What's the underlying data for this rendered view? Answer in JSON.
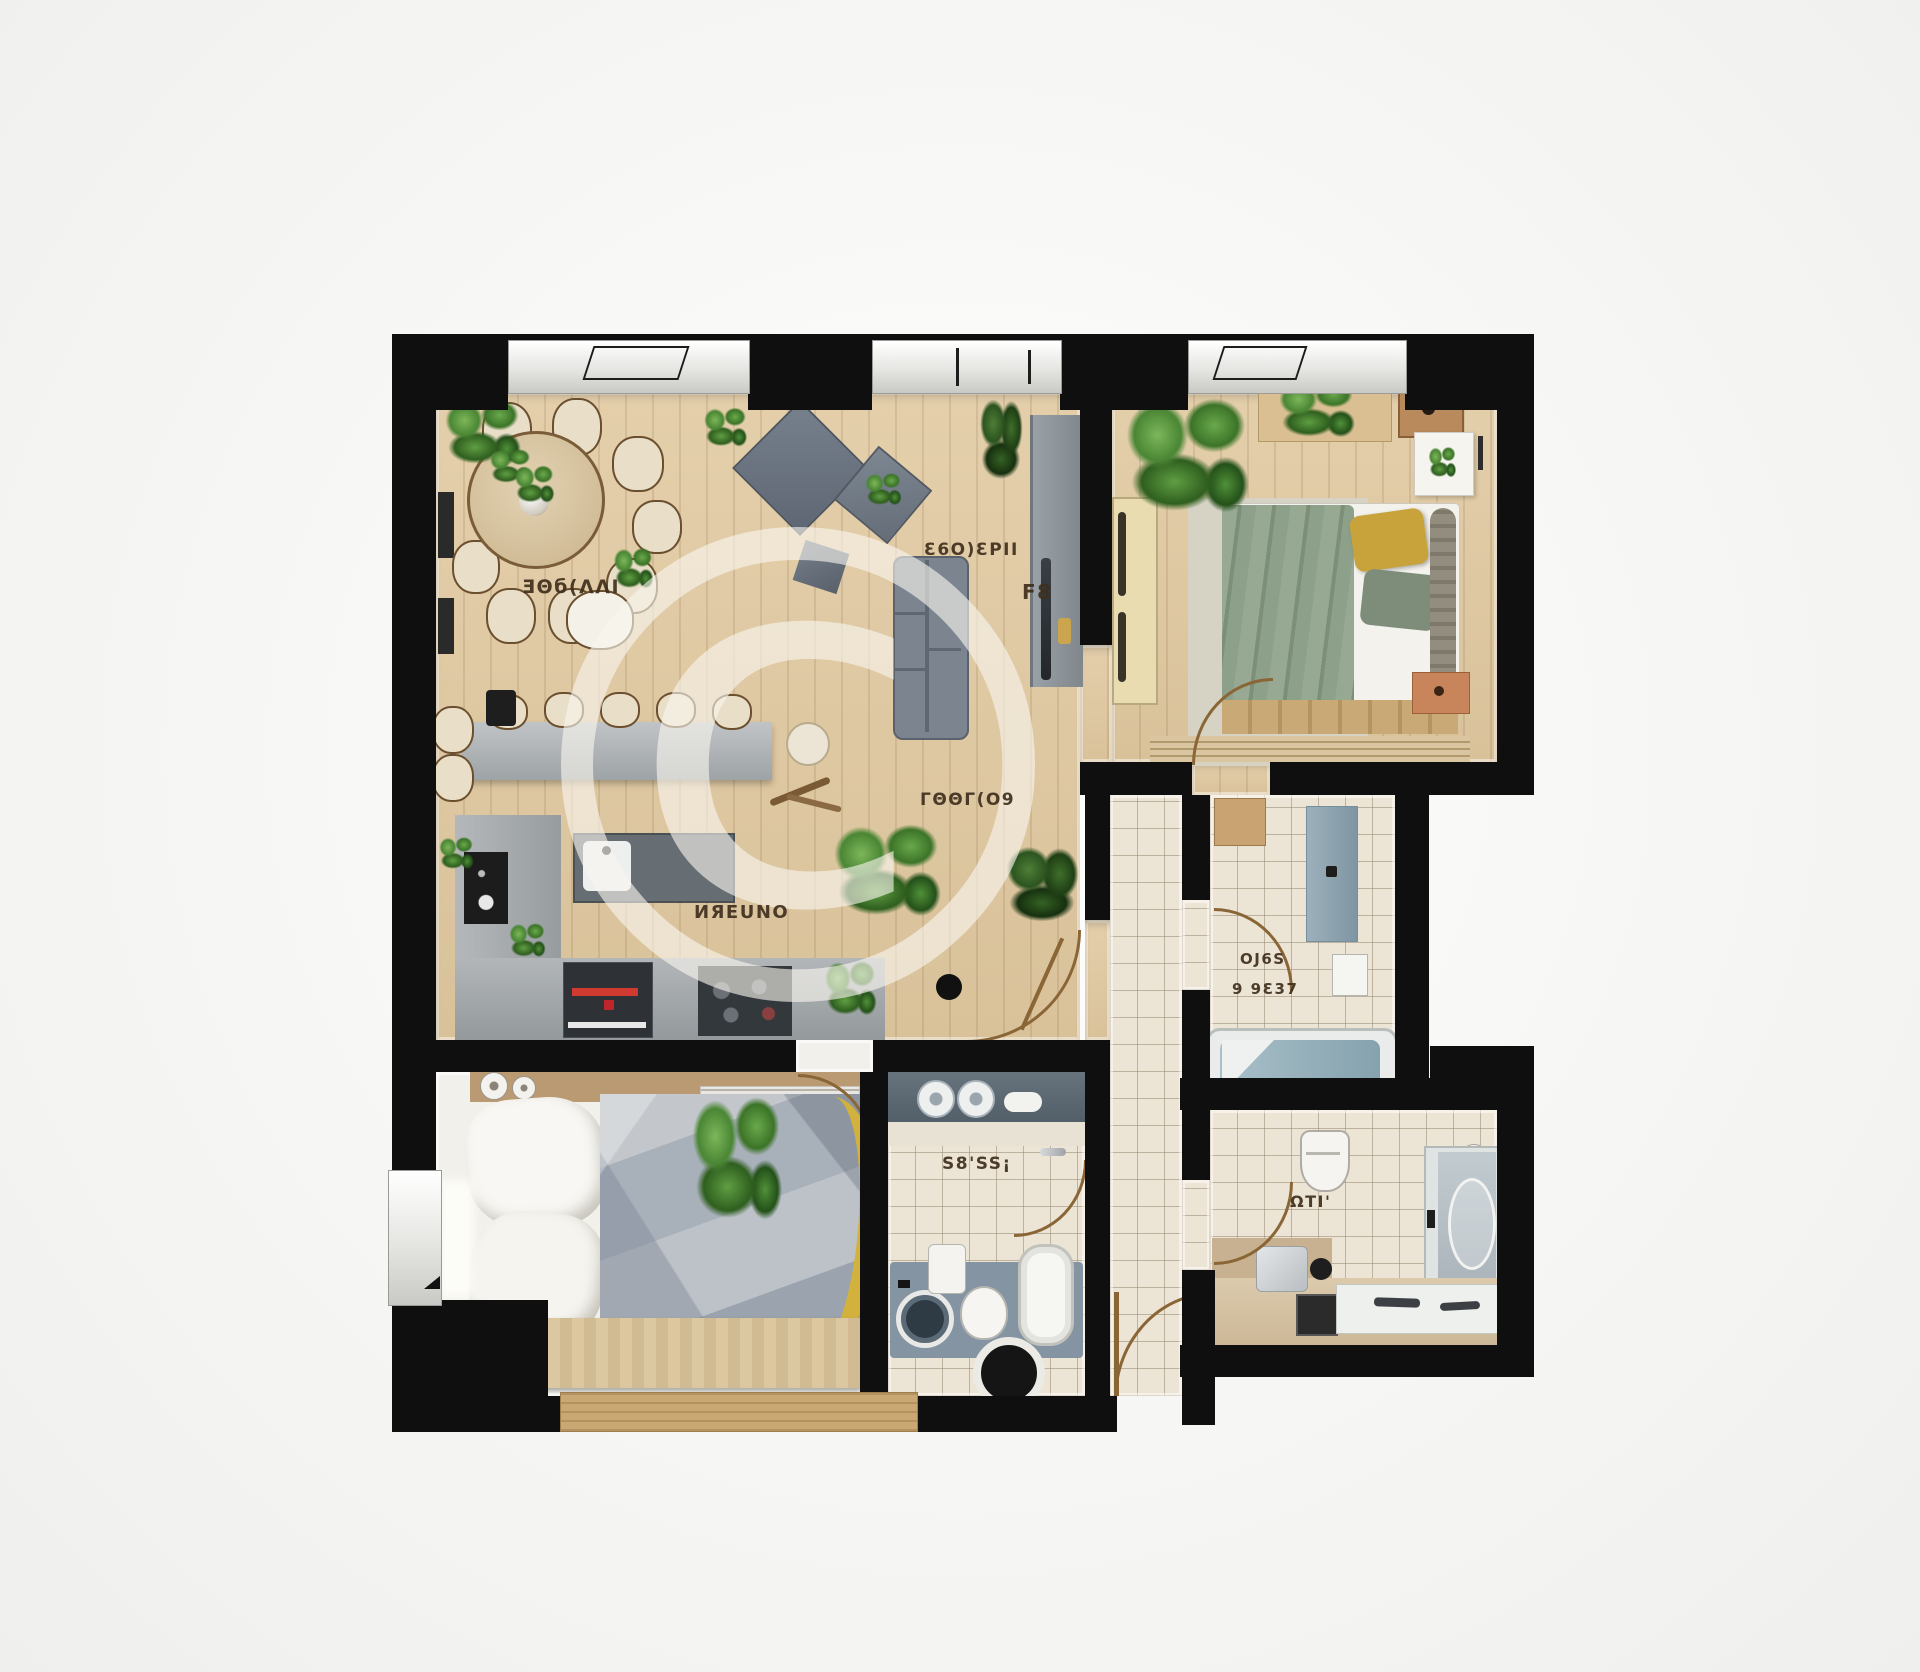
{
  "watermark": {
    "symbol": "©"
  },
  "labels": {
    "dining": "ƎΘб(ΛΛІ",
    "living_a": "Ɛ6Ο)ƐΡΙΙ",
    "living_b": "F8",
    "living_c": "ΓΘΘΓ(Ο9",
    "kitchen": "ИЯΕUΝΟ",
    "bath_left": "S8'SS¡",
    "bath_right_line1": "OЈ6S",
    "bath_right_line2": "9 9Ɛ37",
    "bath_back": "ΩΤΙ'"
  },
  "colors": {
    "wall": "#0f0f0f",
    "wood_floor": "#ddc7a2",
    "tile_floor": "#ece4d4",
    "bedroom_bl_floor": "#f2f0ea",
    "sofa_gray": "#7b848f",
    "blanket_green": "#93a68f",
    "pillow_yellow": "#c8a23a",
    "quilt_yellow": "#d2b23c",
    "tub_water": "#9db6c0",
    "counter_gray": "#a8adb0",
    "island_dark": "#666d73",
    "oven_display_red": "#d03a30",
    "plant_green": "#4a8634",
    "door_arc_brown": "#8a6536",
    "label_text": "#3f2f1d"
  }
}
